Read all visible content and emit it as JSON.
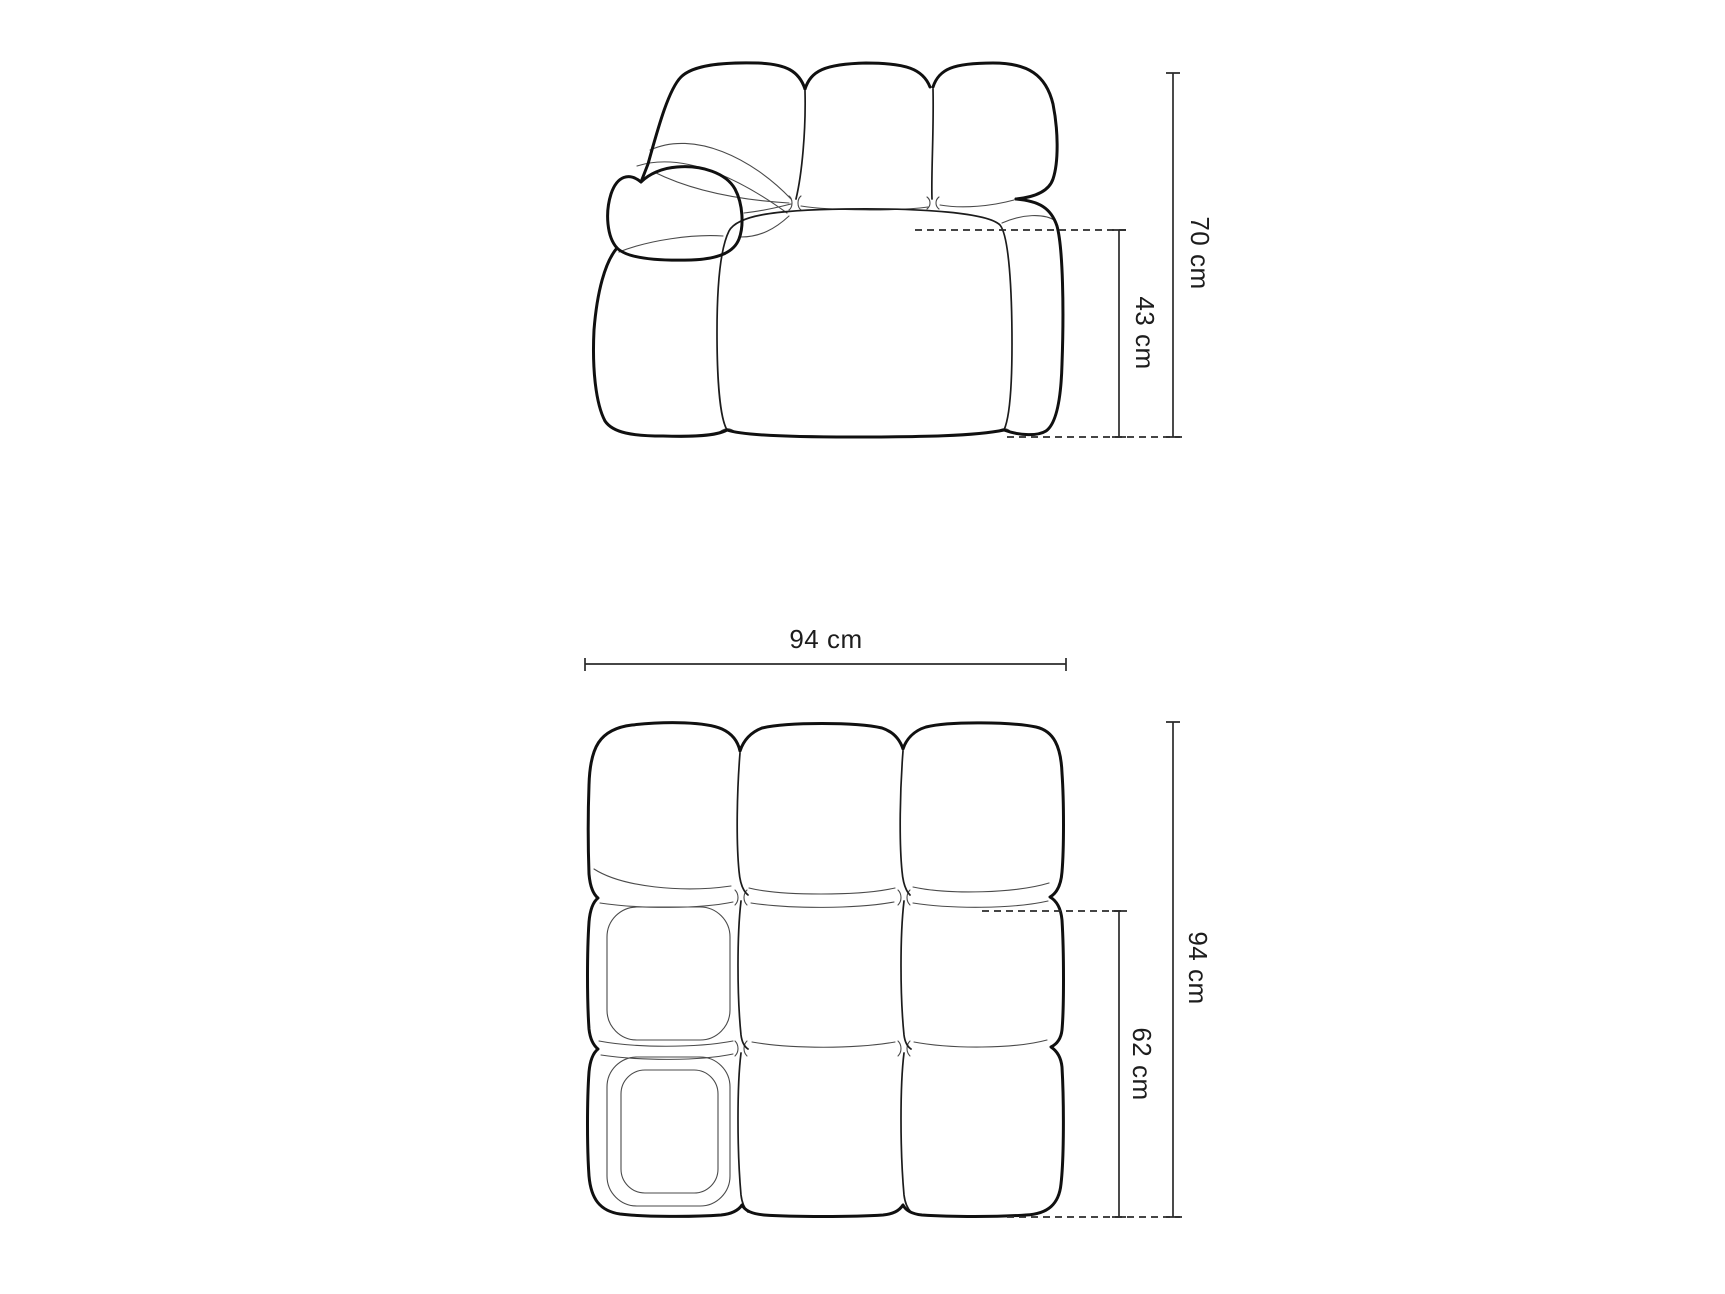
{
  "canvas": {
    "width": 1725,
    "height": 1294,
    "background": "#ffffff"
  },
  "dimensions": {
    "side_view": {
      "total_height": "70 cm",
      "seat_height": "43 cm"
    },
    "top_view": {
      "width": "94 cm",
      "depth": "94 cm",
      "seat_depth": "62 cm"
    }
  },
  "colors": {
    "outline": "#101010",
    "interior_line": "#4a4a4a",
    "dimension_line": "#2b2b2b",
    "label_text": "#1d1d1d",
    "background": "#ffffff"
  }
}
